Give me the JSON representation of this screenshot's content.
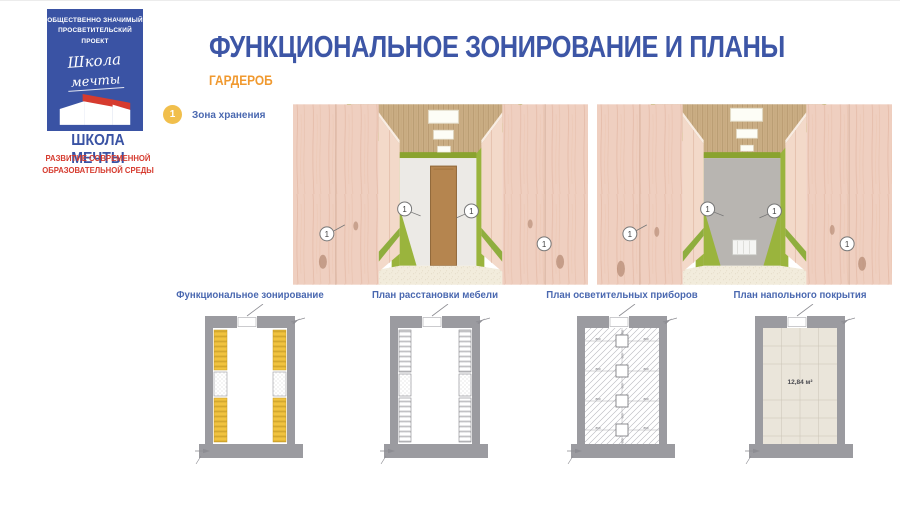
{
  "logo": {
    "project_line1": "ОБЩЕСТВЕННО ЗНАЧИМЫЙ",
    "project_line2": "ПРОСВЕТИТЕЛЬСКИЙ ПРОЕКТ",
    "script_line1": "Школа",
    "script_line2": "мечты",
    "name": "ШКОЛА МЕЧТЫ",
    "tagline_line1": "РАЗВИТИЕ СОВРЕМЕННОЙ",
    "tagline_line2": "ОБРАЗОВАТЕЛЬНОЙ СРЕДЫ"
  },
  "header": {
    "title": "ФУНКЦИОНАЛЬНОЕ ЗОНИРОВАНИЕ И ПЛАНЫ",
    "subtitle": "ГАРДЕРОБ"
  },
  "legend": {
    "items": [
      {
        "number": "1",
        "label": "Зона хранения"
      }
    ]
  },
  "renders": {
    "marker_label": "1"
  },
  "plans": [
    {
      "label": "Функциональное зонирование"
    },
    {
      "label": "План расстановки мебели"
    },
    {
      "label": "План осветительных приборов",
      "dim_h": "860",
      "dim_v": "600"
    },
    {
      "label": "План напольного покрытия",
      "area": "12,84 м²"
    }
  ],
  "colors": {
    "title_blue": "#3d56a6",
    "accent_orange": "#f0992f",
    "logo_blue": "#3a53a4",
    "logo_red": "#d63b2f",
    "text_blue": "#4a68b0",
    "badge_yellow": "#f1bf4c",
    "wall_gray": "#9b9ba0",
    "zone_yellow": "#f1c33f",
    "accent_green": "#9ab43d",
    "panel_pink": "#efcfc0",
    "door_brown": "#b5854f"
  }
}
